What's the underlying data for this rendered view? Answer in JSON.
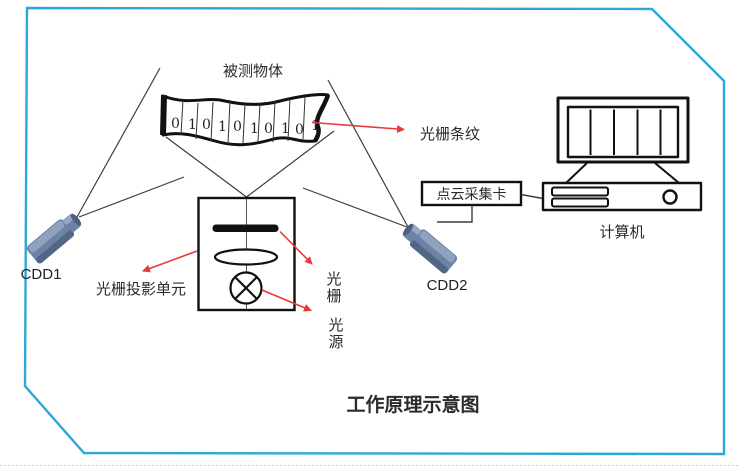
{
  "title": {
    "text": "工作原理示意图"
  },
  "measured_object": {
    "label": "被测物体",
    "digits": [
      "0",
      "1",
      "0",
      "1",
      "0",
      "1",
      "0",
      "1",
      "0",
      "1"
    ]
  },
  "annotations": {
    "fringe_label": "光栅条纹",
    "projector_label": "光栅投影单元",
    "grating_label_chars": [
      "光",
      "栅"
    ],
    "source_label_chars": [
      "光",
      "源"
    ]
  },
  "cameras": {
    "left_label": "CDD1",
    "right_label": "CDD2"
  },
  "capture_card": {
    "label": "点云采集卡"
  },
  "computer": {
    "label": "计算机"
  },
  "colors": {
    "border_blue": "#2fa6d9",
    "arrow_red": "#e8393d",
    "title_red": "#ee0f0f",
    "line_gray": "#3d3d3d",
    "shape_black": "#111111",
    "camera_body": "#6d82a4",
    "camera_light": "#97a8c4",
    "camera_dark": "#4e5f80"
  }
}
